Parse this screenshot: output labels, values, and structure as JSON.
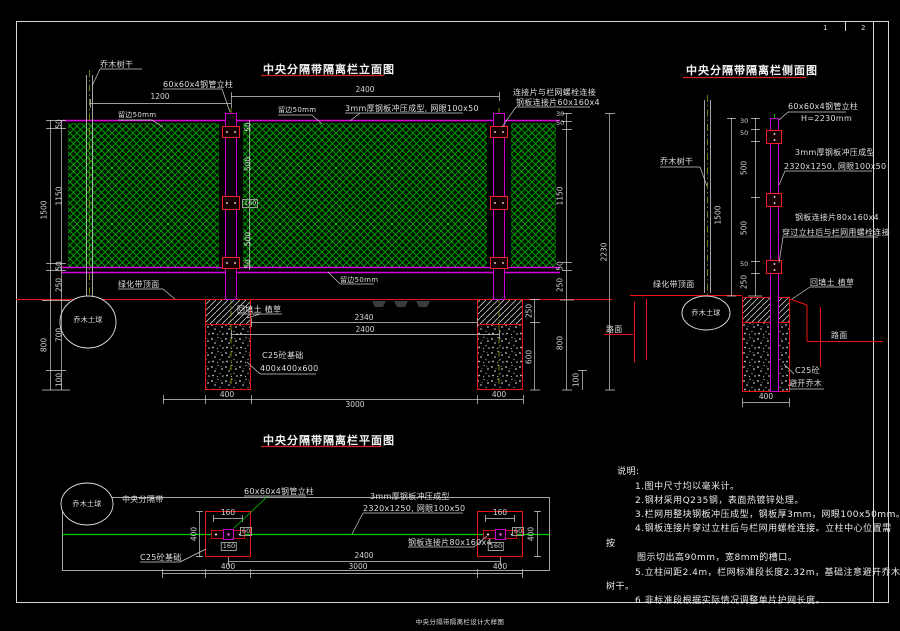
{
  "sheet": {
    "caption": "中央分隔带隔离栏设计大样图",
    "page_1": "1",
    "page_2": "2"
  },
  "common": {
    "tree_trunk": "乔木树干",
    "tree_ball": "乔木土球",
    "belt_top": "绿化带顶面",
    "backfill": "回填土 植草",
    "road": "路面",
    "post_spec": "60x60x4钢管立柱",
    "edge50": "留边50mm"
  },
  "elev": {
    "title": "中央分隔带隔离栏立面图",
    "mesh_spec": "3mm厚钢板冲压成型, 网眼100x50",
    "connect1": "连接片与栏网螺栓连接",
    "connect2": "钢板连接片60x160x4",
    "c25_found": "C25砼基础",
    "found_size": "400x400x600"
  },
  "side": {
    "title": "中央分隔带隔离栏侧面图",
    "post_h": "H=2230mm",
    "mesh1": "3mm厚钢板冲压成型",
    "mesh2": "2320x1250, 网眼100x50",
    "plate1": "钢板连接片80x160x4",
    "plate2": "穿过立柱后与栏网用螺栓连接",
    "c25": "C25砼",
    "c25b": "避开乔木"
  },
  "plan": {
    "title": "中央分隔带隔离栏平面图",
    "median": "中央分隔带",
    "mesh1": "3mm厚钢板冲压成型",
    "mesh2": "2320x1250, 网眼100x50",
    "plate": "钢板连接片80x160x4",
    "c25_found": "C25砼基础"
  },
  "notes": {
    "heading": "说明:",
    "n1": "1.图中尺寸均以毫米计。",
    "n2": "2.钢材采用Q235钢，表面热镀锌处理。",
    "n3": "3.栏网用整块钢板冲压成型，钢板厚3mm，网眼100x50mm。",
    "n4": "4.钢板连接片穿过立柱后与栏网用螺栓连接。立柱中心位置需",
    "n4b": "按",
    "n4c": "图示切出高90mm，宽8mm的槽口。",
    "n5": "5.立柱间距2.4m，栏网标准段长度2.32m，基础注意避开乔木",
    "n5b": "树干。",
    "n6": "6.非标准段根据实际情况调整单片护网长度。"
  },
  "dims": {
    "v30": "30",
    "v50": "50",
    "v60": "60",
    "v100": "100",
    "v160": "160",
    "v250": "250",
    "v400": "400",
    "v500": "500",
    "v600": "600",
    "v700": "700",
    "v800": "800",
    "v1150": "1150",
    "v1200": "1200",
    "v1500": "1500",
    "v2230": "2230",
    "v2340": "2340",
    "v2400": "2400",
    "v3000": "3000"
  },
  "colors": {
    "background": "#000000",
    "line_white": "#d8d8d8",
    "mesh_green": "#00a800",
    "rail_magenta": "#dd00dd",
    "detail_red": "#ee1111",
    "centerline_green": "#00cc00",
    "title_underline": "#cc2222"
  }
}
